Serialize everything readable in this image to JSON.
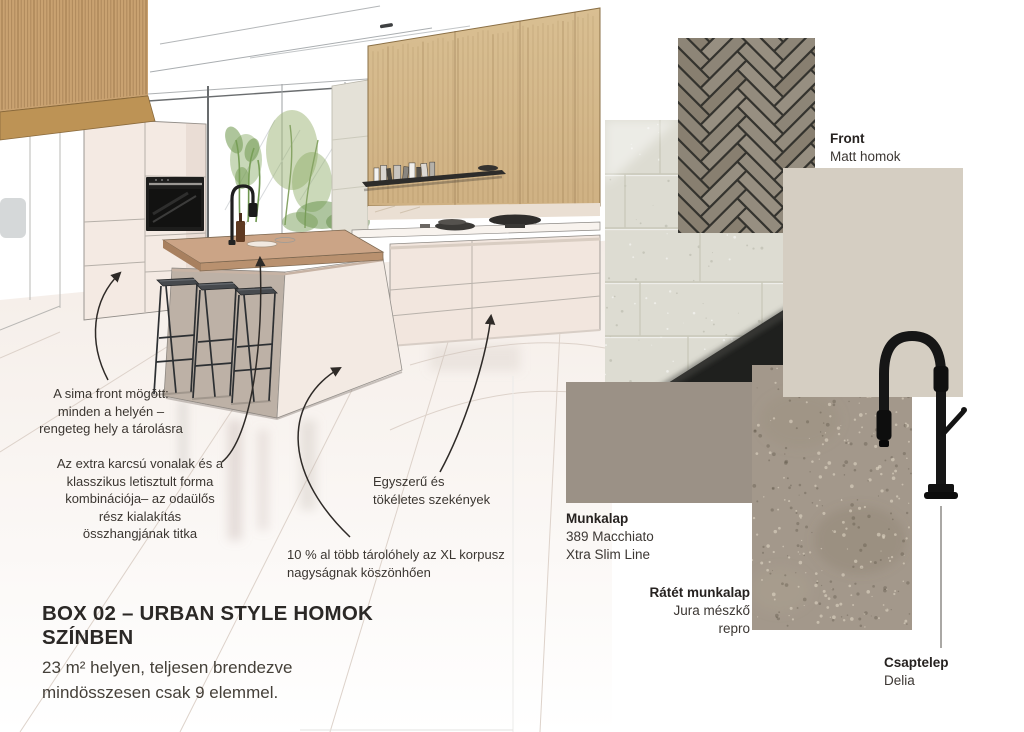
{
  "title": {
    "text": "BOX 02 – URBAN STYLE HOMOK\nSZÍNBEN",
    "subtitle": "23 m² helyen, teljesen brendezve\nmindösszesen csak 9 elemmel."
  },
  "annotations": {
    "front_note": "A sima front mögött:\nminden a helyén –\nrengeteg hely a tárolásra",
    "lines_note": "Az extra karcsú vonalak és a\nklasszikus letisztult forma\nkombinációja– az odaülős\nrész kialakítás\nösszhangjának titka",
    "storage_note": "10 % al több tárolóhely az XL korpusz\nnagyságnak köszönhően",
    "cabinets_note": "Egyszerű és\ntökéletes szekények"
  },
  "materials": {
    "front": {
      "label": "Front",
      "value": "Matt homok"
    },
    "worktop": {
      "label": "Munkalap",
      "value": "389 Macchiato\nXtra Slim Line"
    },
    "overlay": {
      "label": "Rátét munkalap",
      "value": "Jura mészkő\nrepro"
    },
    "tap": {
      "label": "Csaptelep",
      "value": "Delia"
    }
  },
  "colors": {
    "front_panel": "#d5cec2",
    "worktop_macchiato": "#9b9186",
    "stone_jura": "#a3988b",
    "herringbone_tile": "#8f8779",
    "herringbone_grout": "#34332e",
    "concrete_wall": "#dddcd2",
    "tap_black": "#161616",
    "oak_wood": "#d4b88c",
    "island_wood": "#cba486"
  }
}
